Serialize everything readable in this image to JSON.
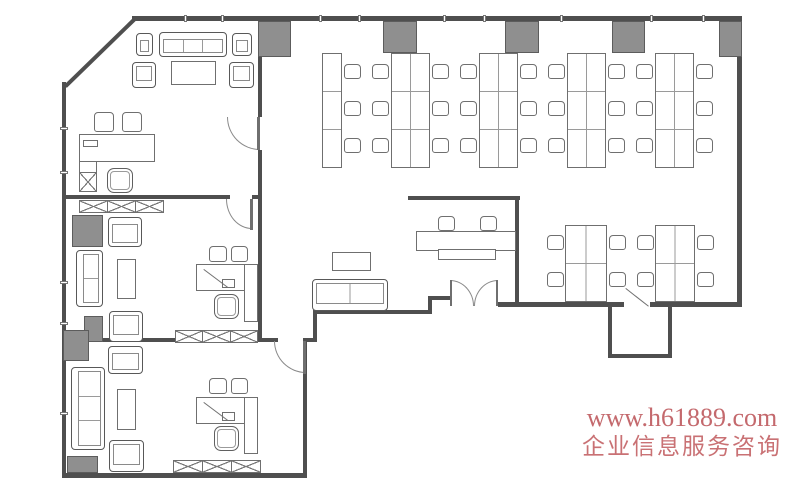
{
  "watermark": {
    "line1": "www.h61889.com",
    "line2": "企业信息服务咨询"
  },
  "colors": {
    "background": "#ffffff",
    "wall": "#4f4f4f",
    "furniture_line": "#6f6f6f",
    "column_fill": "#8f8f8f",
    "watermark_line1": "#c4696d",
    "watermark_line2": "#c97174"
  },
  "plan": {
    "walls": [
      [
        132,
        16,
        610,
        5
      ],
      [
        737,
        16,
        5,
        291
      ],
      [
        650,
        302,
        92,
        5
      ],
      [
        498,
        302,
        126,
        5
      ],
      [
        428,
        296,
        24,
        4
      ],
      [
        428,
        296,
        4,
        18
      ],
      [
        313,
        310,
        117,
        4
      ],
      [
        313,
        310,
        4,
        31
      ],
      [
        64,
        338,
        214,
        4
      ],
      [
        306,
        338,
        11,
        4
      ],
      [
        303,
        338,
        4,
        140
      ],
      [
        62,
        473,
        245,
        5
      ],
      [
        62,
        82,
        4,
        396
      ],
      [
        258,
        20,
        4,
        97
      ],
      [
        258,
        150,
        4,
        46
      ],
      [
        258,
        196,
        4,
        146
      ],
      [
        64,
        195,
        166,
        4
      ],
      [
        252,
        195,
        10,
        4
      ],
      [
        408,
        196,
        112,
        4
      ],
      [
        515,
        196,
        4,
        111
      ],
      [
        608,
        307,
        4,
        51
      ],
      [
        608,
        354,
        64,
        4
      ],
      [
        668,
        307,
        4,
        51
      ]
    ],
    "diag_walls": [
      [
        64,
        85,
        134,
        17,
        4
      ]
    ],
    "columns": [
      [
        258,
        21,
        33,
        36
      ],
      [
        383,
        21,
        34,
        32
      ],
      [
        505,
        21,
        34,
        32
      ],
      [
        612,
        21,
        33,
        32
      ],
      [
        719,
        21,
        23,
        36
      ],
      [
        72,
        215,
        31,
        32
      ],
      [
        84,
        316,
        19,
        26
      ],
      [
        63,
        330,
        26,
        31
      ],
      [
        67,
        456,
        31,
        17
      ]
    ],
    "desk_banks": [
      [
        322,
        53,
        20,
        115,
        1,
        3
      ],
      [
        391,
        53,
        39,
        115,
        2,
        3
      ],
      [
        479,
        53,
        39,
        115,
        2,
        3
      ],
      [
        567,
        53,
        39,
        115,
        2,
        3
      ],
      [
        655,
        53,
        39,
        115,
        2,
        3
      ],
      [
        565,
        225,
        42,
        77,
        2,
        2
      ],
      [
        655,
        225,
        40,
        77,
        2,
        2
      ]
    ],
    "chair_columns": [
      [
        344,
        64,
        3,
        37
      ],
      [
        372,
        64,
        3,
        37
      ],
      [
        432,
        64,
        3,
        37
      ],
      [
        460,
        64,
        3,
        37
      ],
      [
        520,
        64,
        3,
        37
      ],
      [
        548,
        64,
        3,
        37
      ],
      [
        608,
        64,
        3,
        37
      ],
      [
        636,
        64,
        3,
        37
      ],
      [
        696,
        64,
        3,
        37
      ],
      [
        547,
        235,
        2,
        37
      ],
      [
        609,
        235,
        2,
        37
      ],
      [
        637,
        235,
        2,
        37
      ],
      [
        697,
        235,
        2,
        37
      ]
    ],
    "chairs": [
      [
        "reception-chair",
        438,
        216,
        17,
        15
      ],
      [
        "reception-chair",
        480,
        216,
        17,
        15
      ],
      [
        "guest-chair",
        94,
        112,
        20,
        20
      ],
      [
        "guest-chair",
        122,
        112,
        20,
        20
      ],
      [
        "guest-chair",
        209,
        246,
        18,
        16
      ],
      [
        "guest-chair",
        231,
        246,
        17,
        16
      ],
      [
        "guest-chair",
        209,
        378,
        18,
        16
      ],
      [
        "guest-chair",
        231,
        378,
        17,
        16
      ]
    ],
    "exec_chairs": [
      [
        107,
        168,
        26,
        25
      ],
      [
        214,
        294,
        25,
        25
      ],
      [
        214,
        426,
        25,
        25
      ]
    ],
    "sofas": [
      [
        "lobby-sofa",
        312,
        279,
        76,
        32,
        "bottom",
        2
      ],
      [
        "sofa-three-seat",
        159,
        32,
        68,
        25,
        "top",
        3
      ],
      [
        "armchair",
        136,
        33,
        17,
        23,
        "top",
        1
      ],
      [
        "armchair",
        232,
        33,
        20,
        23,
        "top",
        1
      ],
      [
        "armchair",
        132,
        62,
        24,
        26,
        "bottom",
        1
      ],
      [
        "armchair",
        229,
        62,
        25,
        26,
        "bottom",
        1
      ],
      [
        "armchair",
        108,
        217,
        34,
        30,
        "top",
        1
      ],
      [
        "sofa-two-seat",
        76,
        250,
        27,
        57,
        "left",
        2
      ],
      [
        "armchair",
        109,
        311,
        34,
        31,
        "bottom",
        1
      ],
      [
        "armchair",
        108,
        346,
        35,
        28,
        "top",
        1
      ],
      [
        "sofa-three-seat",
        71,
        367,
        34,
        83,
        "left",
        3
      ],
      [
        "armchair",
        109,
        440,
        35,
        32,
        "bottom",
        1
      ]
    ],
    "outline_rects": [
      [
        "executive-desk",
        79,
        134,
        76,
        28
      ],
      [
        "desk-keyboard",
        83,
        140,
        15,
        7
      ],
      [
        "desk-return",
        79,
        161,
        18,
        12
      ],
      [
        "coffee-table",
        171,
        61,
        45,
        24
      ],
      [
        "coffee-table",
        117,
        259,
        19,
        40
      ],
      [
        "office-desk",
        196,
        264,
        49,
        27
      ],
      [
        "desk-return",
        244,
        264,
        14,
        58
      ],
      [
        "desk-keyboard",
        222,
        279,
        13,
        9
      ],
      [
        "coffee-table",
        117,
        389,
        19,
        41
      ],
      [
        "office-desk",
        196,
        397,
        49,
        27
      ],
      [
        "desk-return",
        244,
        397,
        14,
        57
      ],
      [
        "desk-keyboard",
        222,
        412,
        13,
        9
      ],
      [
        "lobby-table",
        332,
        252,
        39,
        19
      ],
      [
        "reception-desk",
        416,
        231,
        100,
        20
      ],
      [
        "reception-tray",
        438,
        249,
        58,
        11
      ]
    ],
    "x_boxes": [
      [
        79,
        172,
        18,
        20
      ]
    ],
    "x_rows": [
      [
        79,
        200,
        84,
        13,
        3
      ],
      [
        175,
        330,
        82,
        13,
        3
      ],
      [
        173,
        460,
        87,
        13,
        3
      ]
    ],
    "door_arcs": [
      [
        227,
        117,
        33,
        33,
        "bl"
      ],
      [
        226,
        199,
        26,
        30,
        "bl"
      ],
      [
        274,
        341,
        32,
        32,
        "bl"
      ],
      [
        450,
        280,
        24,
        26,
        "tr"
      ],
      [
        474,
        280,
        24,
        26,
        "tl"
      ]
    ],
    "door_leaves": [
      [
        257,
        117,
        3,
        33
      ],
      [
        250,
        199,
        3,
        31
      ],
      [
        303,
        341,
        3,
        33
      ],
      [
        450,
        280,
        2,
        26
      ],
      [
        496,
        280,
        2,
        26
      ]
    ],
    "diag_lines": [
      [
        204,
        269,
        228,
        287
      ],
      [
        204,
        402,
        228,
        420
      ],
      [
        626,
        288,
        649,
        306
      ]
    ],
    "ticks": [
      [
        60,
        127,
        8,
        3
      ],
      [
        60,
        171,
        8,
        3
      ],
      [
        60,
        281,
        8,
        3
      ],
      [
        60,
        322,
        8,
        3
      ],
      [
        60,
        412,
        8,
        3
      ],
      [
        184,
        15,
        3,
        7
      ],
      [
        221,
        15,
        3,
        7
      ],
      [
        319,
        15,
        3,
        7
      ],
      [
        358,
        15,
        3,
        7
      ],
      [
        443,
        15,
        3,
        7
      ],
      [
        483,
        15,
        3,
        7
      ],
      [
        560,
        15,
        3,
        7
      ],
      [
        650,
        15,
        3,
        7
      ],
      [
        702,
        15,
        3,
        7
      ]
    ]
  }
}
